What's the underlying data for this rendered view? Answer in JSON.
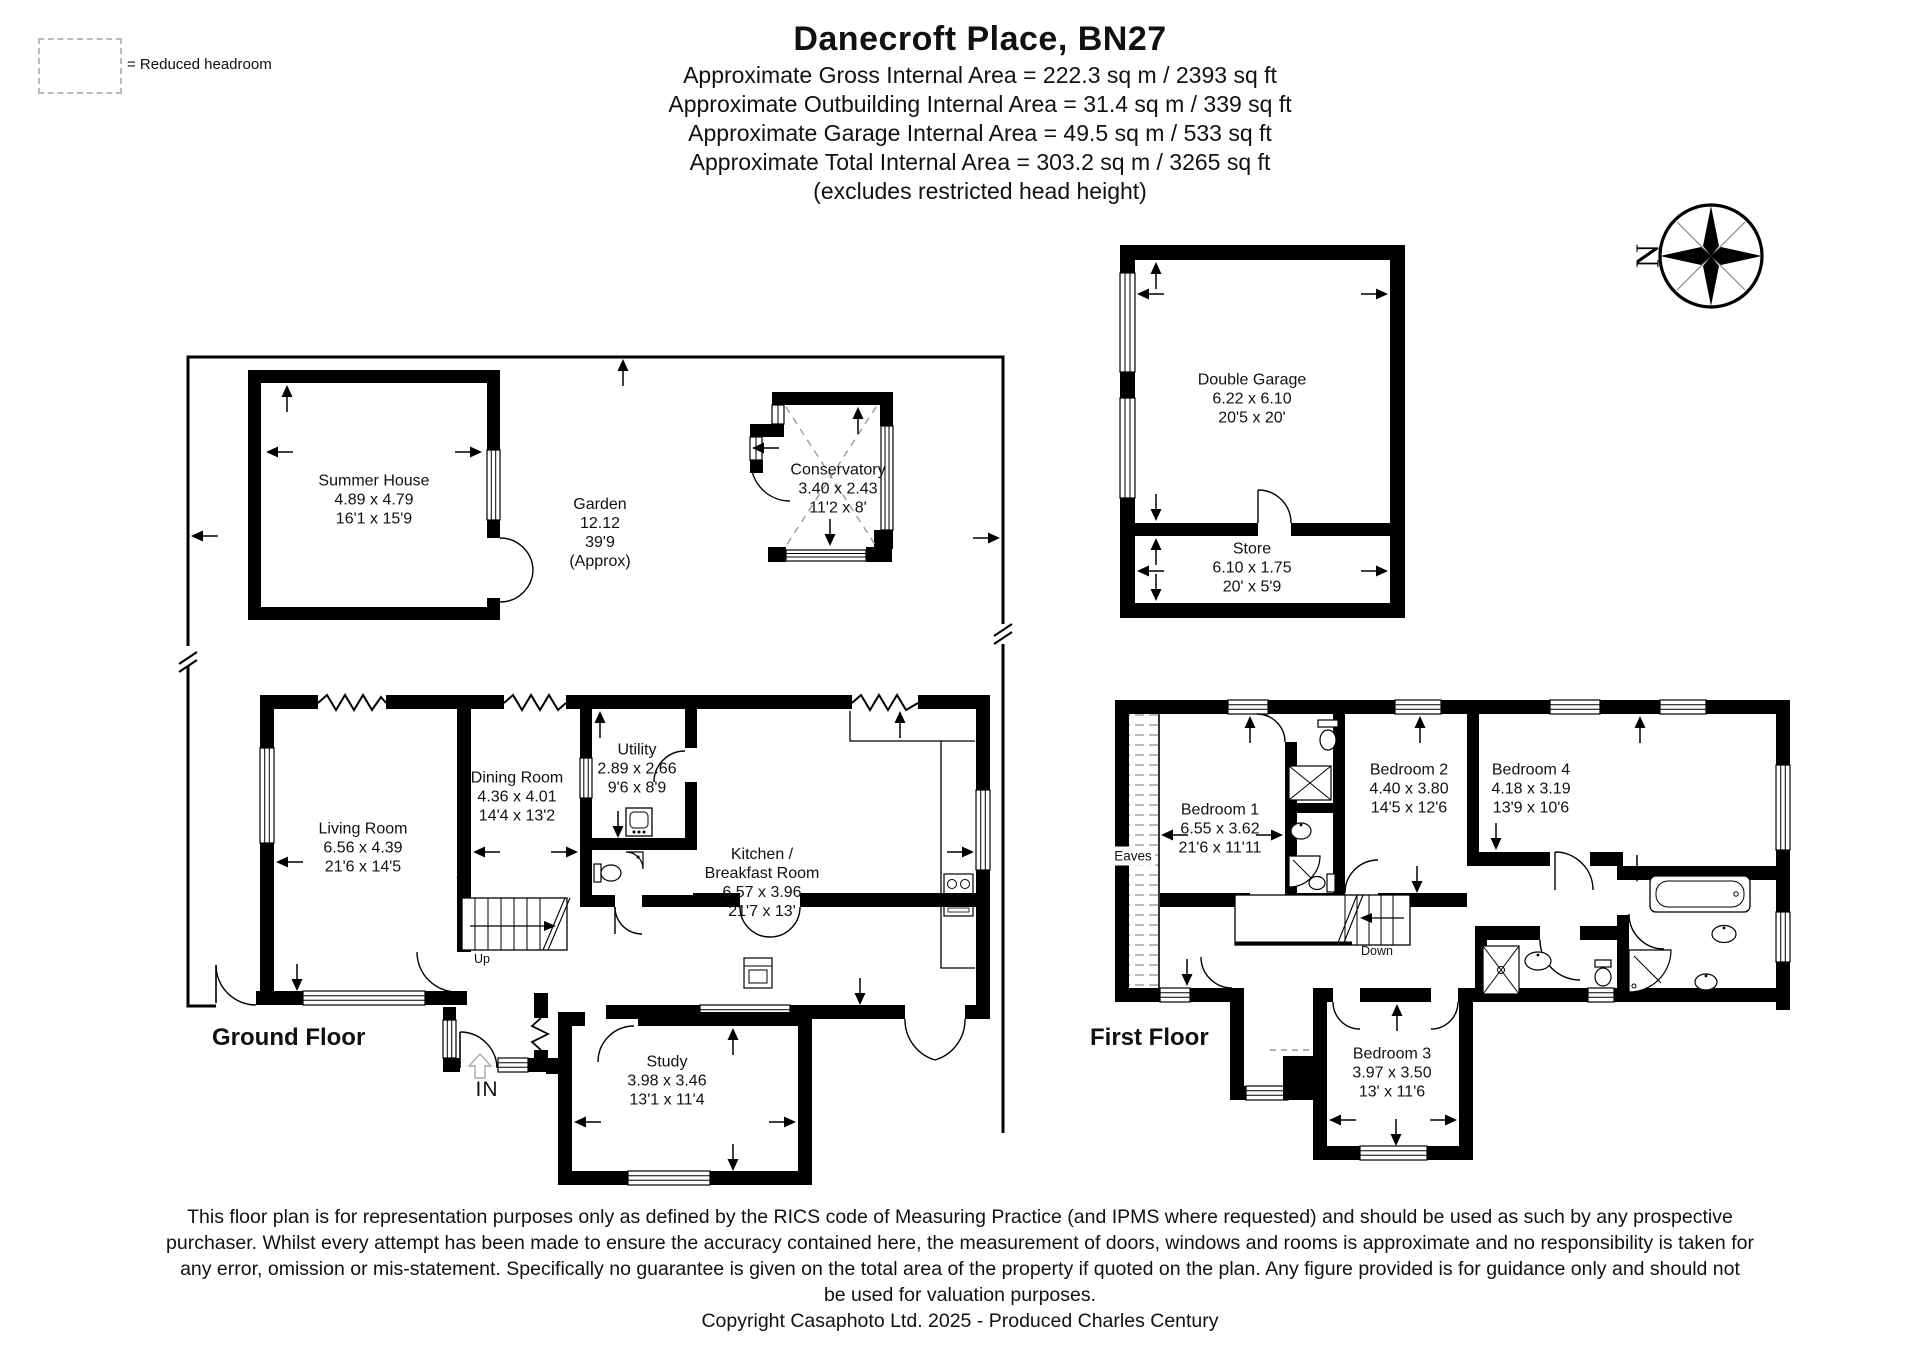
{
  "header": {
    "legend_label": "= Reduced headroom",
    "title": "Danecroft Place, BN27",
    "subtitle_lines": [
      "Approximate Gross Internal Area = 222.3 sq m / 2393 sq ft",
      "Approximate Outbuilding Internal Area = 31.4 sq m / 339 sq ft",
      "Approximate Garage Internal Area = 49.5 sq m / 533 sq ft",
      "Approximate Total Internal Area = 303.2 sq m / 3265 sq ft",
      "(excludes restricted head height)"
    ]
  },
  "compass": {
    "north_label": "N"
  },
  "floors": {
    "ground_label": "Ground Floor",
    "first_label": "First Floor"
  },
  "annotations": {
    "in_label": "IN",
    "up_label": "Up",
    "down_label": "Down",
    "eaves_label": "Eaves"
  },
  "rooms": {
    "summer_house": {
      "name": "Summer House",
      "metric": "4.89 x 4.79",
      "imperial": "16'1 x 15'9"
    },
    "garden": {
      "name": "Garden",
      "metric": "12.12",
      "imperial": "39'9",
      "note": "(Approx)"
    },
    "conservatory": {
      "name": "Conservatory",
      "metric": "3.40 x 2.43",
      "imperial": "11'2 x 8'"
    },
    "double_garage": {
      "name": "Double Garage",
      "metric": "6.22 x 6.10",
      "imperial": "20'5 x 20'"
    },
    "store": {
      "name": "Store",
      "metric": "6.10 x 1.75",
      "imperial": "20' x 5'9"
    },
    "living_room": {
      "name": "Living Room",
      "metric": "6.56 x 4.39",
      "imperial": "21'6 x 14'5"
    },
    "dining_room": {
      "name": "Dining Room",
      "metric": "4.36 x 4.01",
      "imperial": "14'4 x 13'2"
    },
    "utility": {
      "name": "Utility",
      "metric": "2.89 x 2.66",
      "imperial": "9'6 x 8'9"
    },
    "kitchen": {
      "name_line1": "Kitchen /",
      "name_line2": "Breakfast Room",
      "metric": "6.57 x 3.96",
      "imperial": "21'7 x 13'"
    },
    "study": {
      "name": "Study",
      "metric": "3.98 x 3.46",
      "imperial": "13'1 x 11'4"
    },
    "bedroom1": {
      "name": "Bedroom 1",
      "metric": "6.55 x 3.62",
      "imperial": "21'6 x 11'11"
    },
    "bedroom2": {
      "name": "Bedroom 2",
      "metric": "4.40 x 3.80",
      "imperial": "14'5 x 12'6"
    },
    "bedroom3": {
      "name": "Bedroom 3",
      "metric": "3.97 x 3.50",
      "imperial": "13' x 11'6"
    },
    "bedroom4": {
      "name": "Bedroom 4",
      "metric": "4.18 x 3.19",
      "imperial": "13'9 x 10'6"
    }
  },
  "footer": {
    "disclaimer_lines": [
      "This floor plan is for representation purposes only as defined by the RICS code of Measuring Practice (and IPMS where requested) and should be used as such by any prospective",
      "purchaser. Whilst every attempt has been made to ensure the accuracy contained here, the measurement of doors, windows and rooms is approximate and no responsibility is taken for",
      "any error, omission or mis-statement. Specifically no guarantee is given on the total area of the property if quoted on the plan. Any figure provided is for guidance only and should not",
      "be used for valuation purposes."
    ],
    "copyright": "Copyright Casaphoto Ltd. 2025 - Produced Charles Century"
  }
}
